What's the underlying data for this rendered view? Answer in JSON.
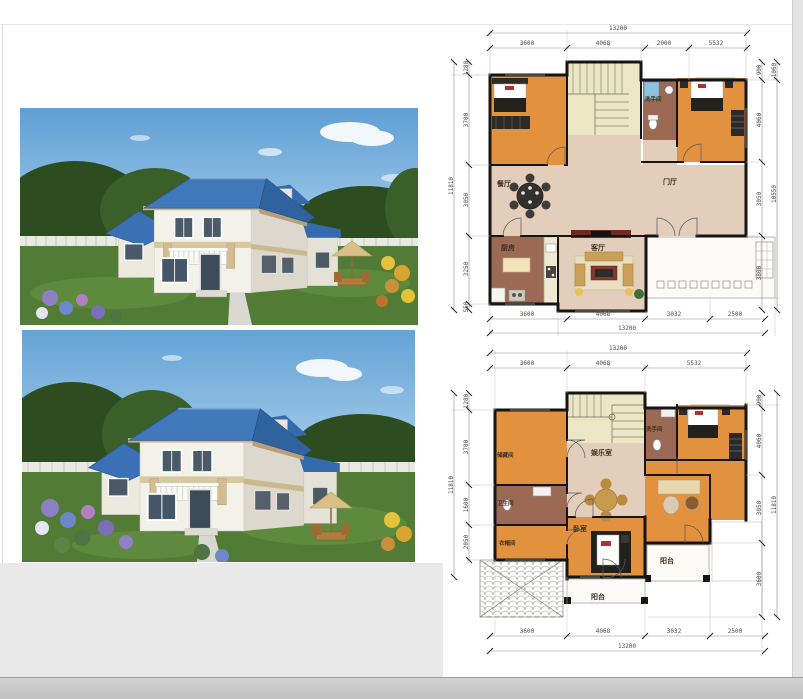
{
  "palette": {
    "roof_blue": "#3f74b8",
    "wall_white": "#f2f1ea",
    "floor_orange": "#e2923f",
    "hall_tan": "#e3cdbb",
    "room_brown": "#9c6a54",
    "stairs_yellow": "#ebe6c4",
    "lawn_green": "#527c35",
    "sky_blue": "#6aa7d8"
  },
  "plan1": {
    "top_total": "13200",
    "top_segments": [
      "3600",
      "4068",
      "2000",
      "5532"
    ],
    "bottom_segments": [
      "3600",
      "4068",
      "3032",
      "2500"
    ],
    "bottom_total": "13200",
    "left_total": "11810",
    "left_segments": [
      "1280",
      "3700",
      "3050",
      "3250",
      "550"
    ],
    "right_segments": [
      "900",
      "4060",
      "3050",
      "3800"
    ],
    "right_outer_top": "1060",
    "right_outer_total": "10550",
    "rooms": {
      "dining": "餐厅",
      "foyer": "门厅",
      "kitchen": "厨房",
      "living": "客厅",
      "bathroom": "洗手间"
    }
  },
  "plan2": {
    "top_total": "13200",
    "top_segments": [
      "3600",
      "4068",
      "5532"
    ],
    "bottom_segments": [
      "3600",
      "4068",
      "3032",
      "2500"
    ],
    "bottom_total": "13200",
    "left_total": "11810",
    "left_segments": [
      "1280",
      "3700",
      "1600",
      "2050"
    ],
    "right_segments": [
      "900",
      "4060",
      "3050",
      "3600"
    ],
    "right_total": "11810",
    "rooms": {
      "storage": "储藏间",
      "bathroom_right": "洗手间",
      "recreation": "娱乐室",
      "toilet_left": "卫生间",
      "cloakroom": "衣帽间",
      "bedroom": "卧室",
      "balcony_right": "阳台",
      "balcony_bottom": "阳台"
    }
  }
}
